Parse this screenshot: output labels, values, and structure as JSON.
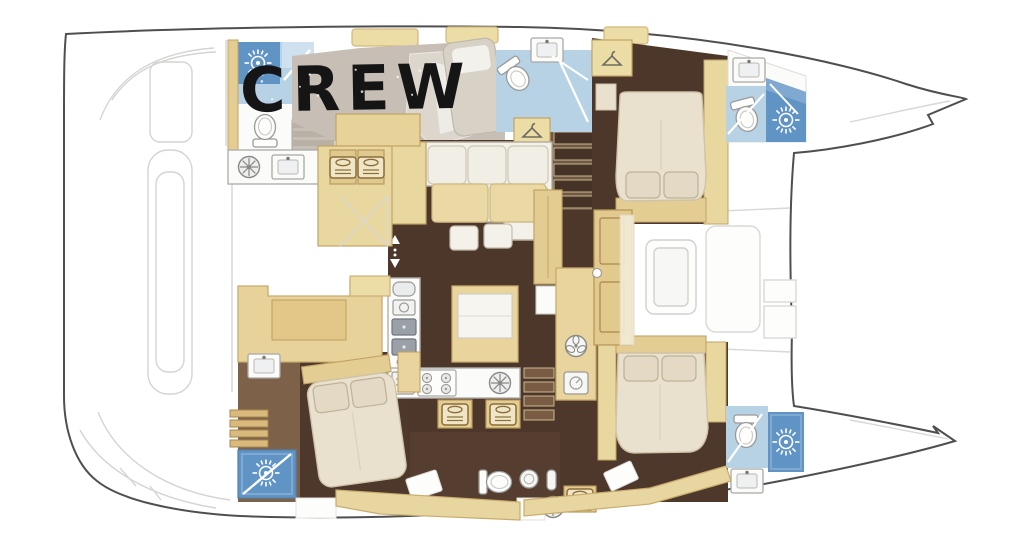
{
  "floorplan": {
    "label": "CREW",
    "kind": "catamaran yacht deck plan"
  },
  "colors": {
    "hull_outline": "#4f4f4f",
    "faint_deck_line": "#d4d4d2",
    "deck_gray": "#c7bfb5",
    "lounger_greige": "#dcd6cc",
    "furniture_tan": "#e9d7a0",
    "furniture_tan_dark": "#d9ba7d",
    "tan_stroke": "#c3a365",
    "floor_dark_brown": "#4c372a",
    "floor_mid_brown": "#6f5846",
    "floor_wood": "#7d6148",
    "bed_cream": "#e9e1ce",
    "pillow_cream": "#e3d9c4",
    "bathroom_blue_light": "#b7d1e5",
    "bathroom_blue_pale": "#cfe0ee",
    "shower_blue_deep": "#6094c5",
    "counter_white": "#fbfbfa",
    "appliance_gray": "#9aa0a8",
    "label_black": "#151515"
  },
  "icons": {
    "sun_icon": "white starburst shower light",
    "toilet_icon": "toilet bowl with tank",
    "sink_icon": "basin with faucet dot",
    "double_sink_icon": "gray square basin",
    "stove_icon": "four burner hob",
    "hob_wheel_icon": "round burner with spokes",
    "bunk_icon": "small berth with pillow",
    "hanger_icon": "clothes hanger",
    "fan_icon": "ventilation fan",
    "dial_icon": "round gauge",
    "washer_icon": "round porthole washer",
    "bottle_icon": "bottle",
    "kettle_icon": "kettle",
    "coffee_machine_icon": "coffee machine",
    "oven_icon": "oven with grill lines",
    "stairs_up_arrow": "white up/down arrows"
  }
}
